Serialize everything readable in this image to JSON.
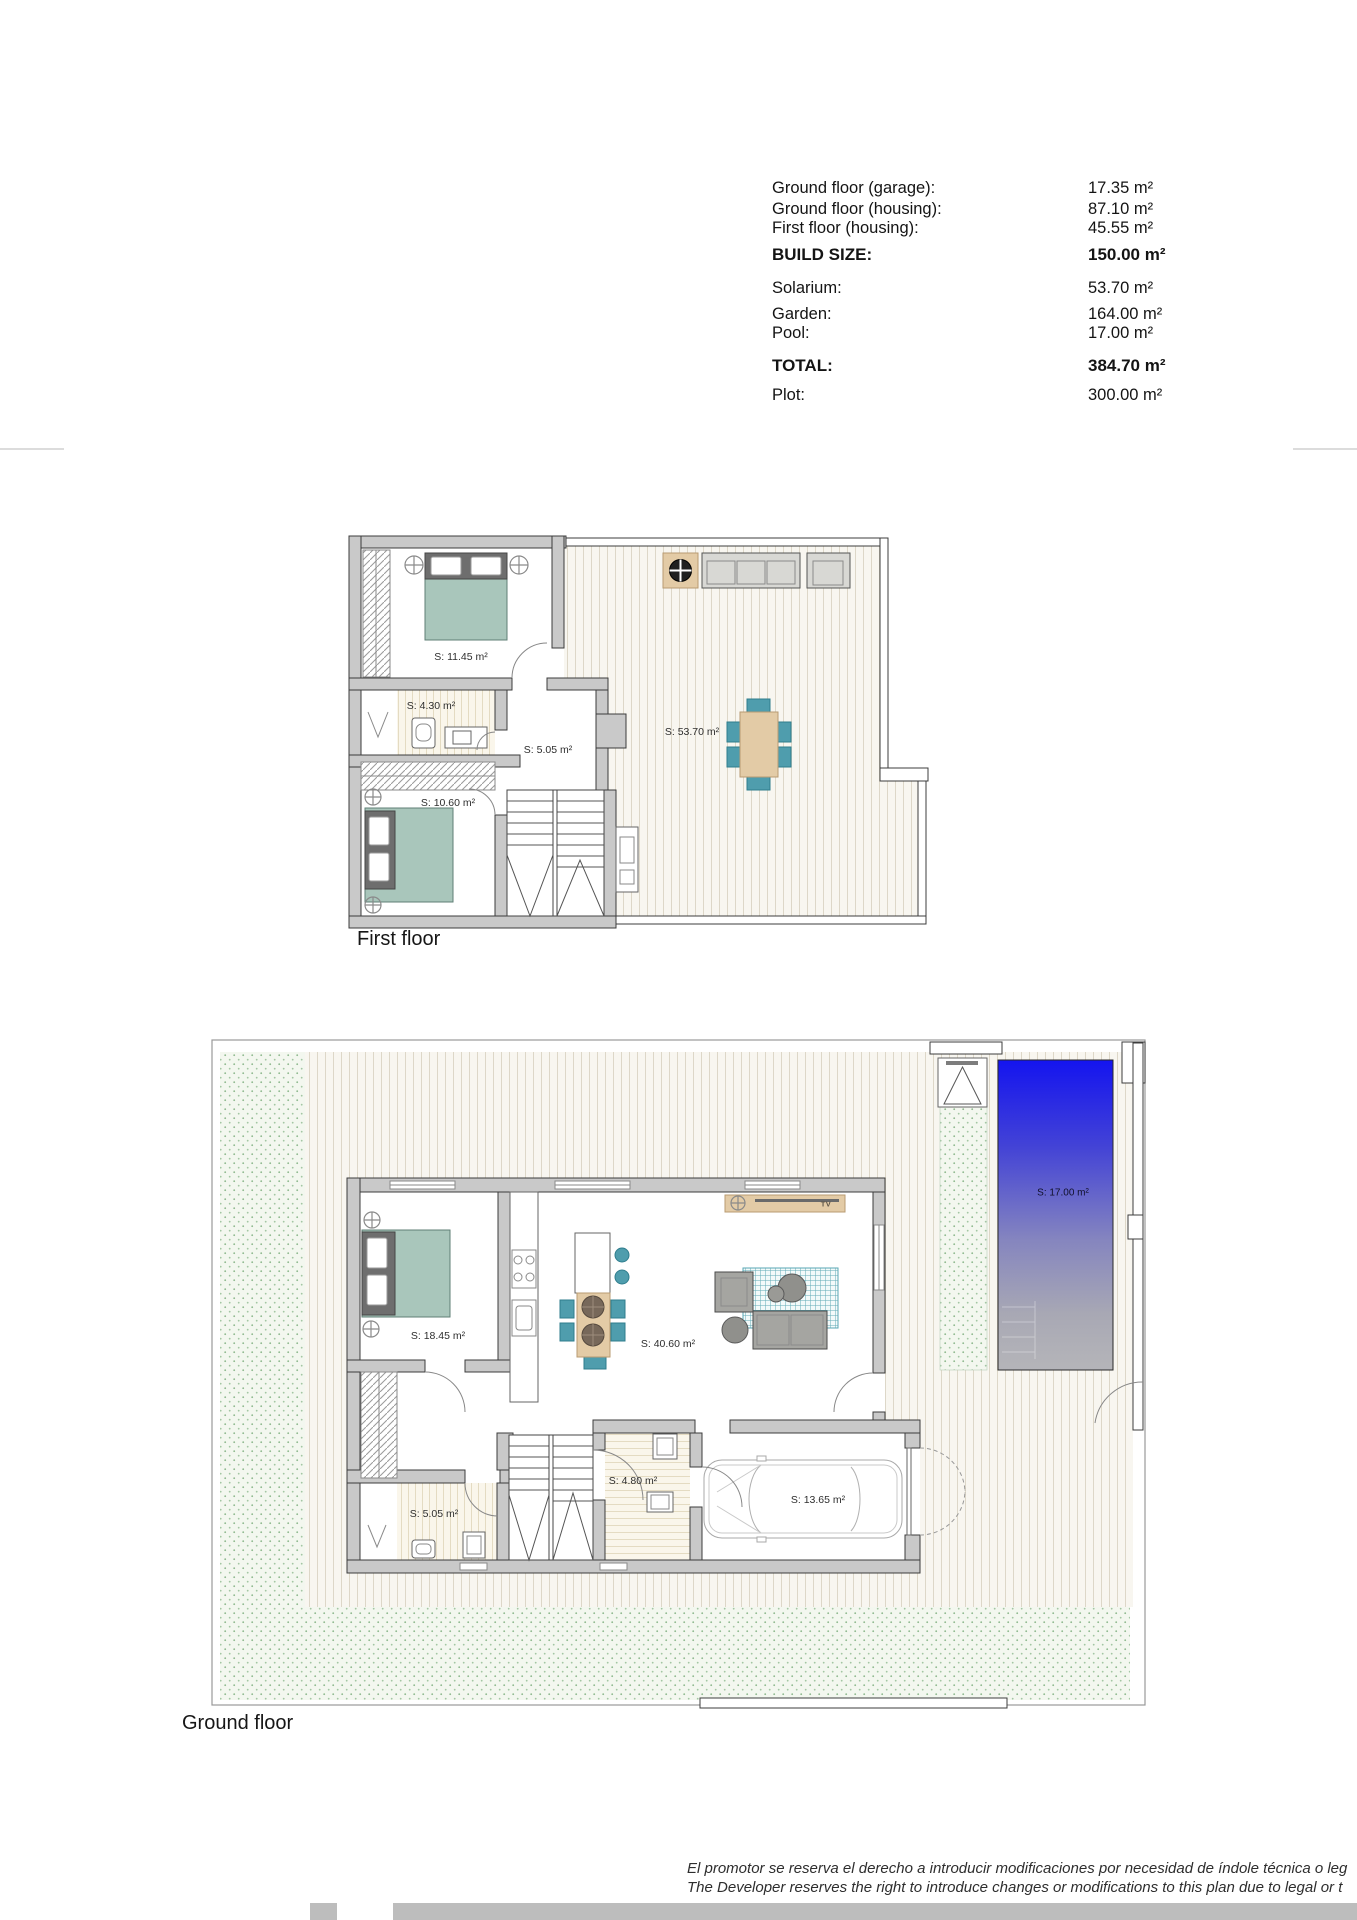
{
  "summary": {
    "rows": [
      {
        "label": "Ground floor (garage):",
        "value": "17.35 m²"
      },
      {
        "label": "Ground floor (housing):",
        "value": "87.10 m²"
      },
      {
        "label": "First floor (housing):",
        "value": "45.55 m²"
      },
      {
        "label": "BUILD SIZE:",
        "value": "150.00 m²"
      },
      {
        "label": "Solarium:",
        "value": "53.70 m²"
      },
      {
        "label": "Garden:",
        "value": "164.00 m²"
      },
      {
        "label": "Pool:",
        "value": "17.00 m²"
      },
      {
        "label": "TOTAL:",
        "value": "384.70 m²"
      },
      {
        "label": "Plot:",
        "value": "300.00 m²"
      }
    ]
  },
  "first_floor": {
    "title": "First floor",
    "labels": {
      "bedroom_1": "S: 11.45 m²",
      "bathroom": "S: 4.30 m²",
      "hall": "S: 5.05 m²",
      "bedroom_2": "S: 10.60 m²",
      "solarium": "S: 53.70 m²"
    }
  },
  "ground_floor": {
    "title": "Ground floor",
    "tv_label": "TV",
    "labels": {
      "bedroom": "S: 18.45 m²",
      "living_kitchen": "S: 40.60 m²",
      "laundry": "S: 4.80 m²",
      "bathroom": "S: 5.05 m²",
      "garage": "S: 13.65 m²",
      "pool": "S: 17.00 m²"
    }
  },
  "footer": {
    "disclaimer_line1": "El promotor se reserva el derecho a introducir modificaciones por necesidad de índole técnica o leg",
    "disclaimer_line2": "The Developer reserves the right to introduce changes or modifications to this plan due to legal or t"
  },
  "colors": {
    "wall_gray": "#c9c9c9",
    "teal_furniture": "#4f9dad",
    "bed_green": "#a9c6bb",
    "wood_tan": "#e3cba6",
    "pool_blue": "#1414ef",
    "garden_dot_green": "#8db88d"
  }
}
